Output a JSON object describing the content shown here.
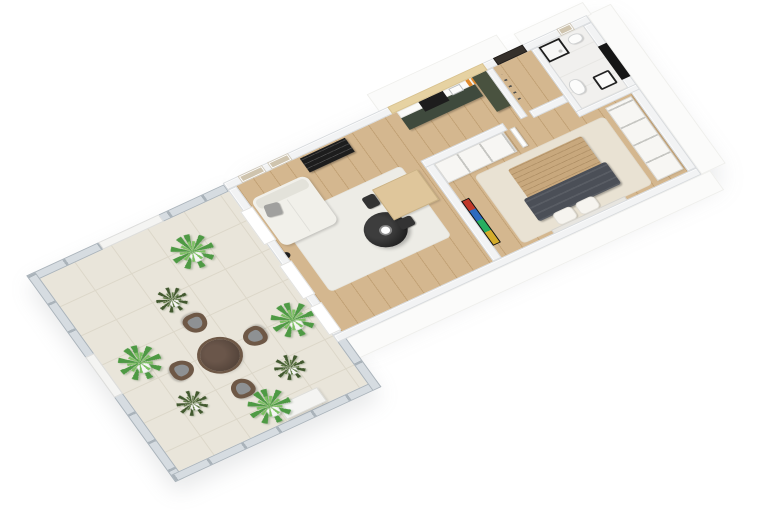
{
  "scene": {
    "type": "3d-floorplan-render",
    "view": "isometric-top-down",
    "background": "#ffffff",
    "apartment_rooms": 5,
    "visible_text": ""
  },
  "palette": {
    "wall": "#f2f3f4",
    "walledge": "#d7dadd",
    "ext": "#fbfbfa",
    "wood": "#d4b78f",
    "woodline": "#c2a276",
    "tile": "#e9e5da",
    "tileline": "#dcd7c9",
    "bathfloor": "#f1f0ee",
    "greencab": "#3f4a3d",
    "greentall": "#49523f",
    "counter": "#fafaf8",
    "black": "#1d1d1d",
    "panelwood": "#e6d2a2",
    "sofa": "#f1f0ea",
    "sofaback": "#e3e2da",
    "pillowgrey": "#a0a09e",
    "rugliving": "#edece6",
    "rugbed": "#e9e2d3",
    "blanket": "#c8a87d",
    "throw": "#4b4f57",
    "pillowwhite": "#f6f4ef",
    "tablewood": "#dfc69b",
    "chairblack": "#333333",
    "wardrobe": "#f7f6f3",
    "handleline": "#c6c6c2",
    "railglass": "#d6dce1",
    "railpost": "#aab3ba",
    "railwhite": "#f4f4f2",
    "chairbrown": "#6e5846",
    "cushion": "#8e9193",
    "tablebrown": "#54443a",
    "tablerim": "#6e5846",
    "plant1": "#4e9a44",
    "plant2": "#7cc162",
    "plantdark": "#42592f",
    "pot": "#f6f6f4",
    "door": "#35302b",
    "orange": "#e08a2d",
    "art": "#cfc4ae"
  },
  "rooms": [
    {
      "name": "living-room",
      "floor": "light-wood",
      "furniture": [
        "white-sofa",
        "grey-throw-pillow",
        "black-floor-lamp",
        "black-media-shelf",
        "black-round-coffee-table",
        "white-cup",
        "white-rug",
        "two-wall-frames"
      ]
    },
    {
      "name": "kitchen",
      "floor": "light-wood",
      "furniture": [
        "dark-green-cabinet-run",
        "white-countertop",
        "black-cooktop-oven",
        "sink",
        "orange-bottles",
        "birch-wood-back-panel",
        "tall-green-cabinet"
      ]
    },
    {
      "name": "dining-area",
      "floor": "light-wood",
      "furniture": [
        "light-wood-dining-table",
        "two-black-chairs"
      ]
    },
    {
      "name": "hallway",
      "floor": "light-wood",
      "furniture": [
        "dark-front-door",
        "coat-hooks"
      ]
    },
    {
      "name": "bathroom",
      "floor": "white-marble-tile",
      "furniture": [
        "black-frame-shower",
        "bidet",
        "toilet",
        "black-frame-sink",
        "wall-art",
        "black-wall-panel"
      ]
    },
    {
      "name": "bedroom",
      "floor": "light-wood",
      "furniture": [
        "double-bed-beige-striped-blanket",
        "dark-grey-throw",
        "two-white-pillows",
        "cream-rug",
        "white-wardrobe-north",
        "white-wardrobe-east",
        "wall-tv-colorful-screen",
        "open-white-door"
      ]
    },
    {
      "name": "terrace",
      "floor": "beige-tiles",
      "furniture": [
        "glass-railing-with-posts",
        "white-privacy-panels",
        "white-planter-box",
        "round-brown-table",
        "four-wicker-chairs-grey-cushions",
        "seven-potted-plants"
      ]
    }
  ],
  "counts": {
    "terrace_chairs": 4,
    "potted_plants": 7,
    "west_wall_windows": 2,
    "west_wall_doors": 1,
    "dining_chairs": 2,
    "wall_frames_living": 2
  }
}
